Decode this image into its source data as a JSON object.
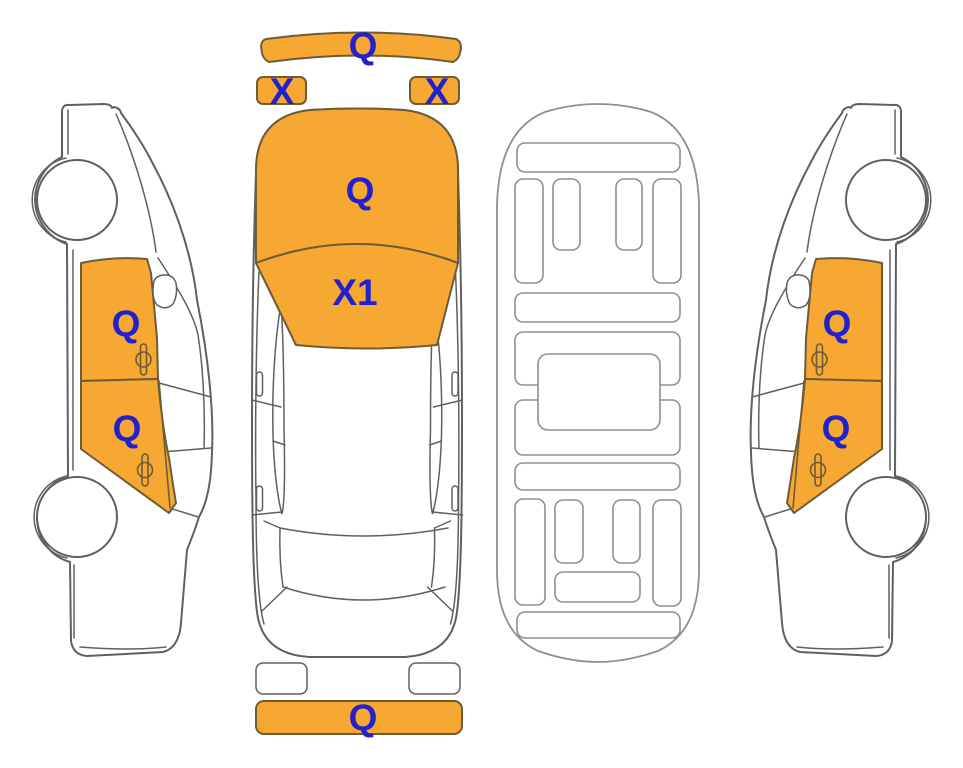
{
  "colors": {
    "background": "#FFFFFF",
    "highlight": "#F6A832",
    "highlight_border": "#6E5C38",
    "outline": "#606060",
    "outline_light": "#9A9A9A",
    "interior_line": "#8F8F8F",
    "label": "#2121CE"
  },
  "views": {
    "left_side": {
      "front_door": "Q",
      "rear_door": "Q"
    },
    "top": {
      "front_bumper": "Q",
      "headlight_left": "X",
      "headlight_right": "X",
      "hood": "Q",
      "windshield": "X1",
      "rear_bumper": "Q"
    },
    "right_side": {
      "front_door": "Q",
      "rear_door": "Q"
    }
  }
}
